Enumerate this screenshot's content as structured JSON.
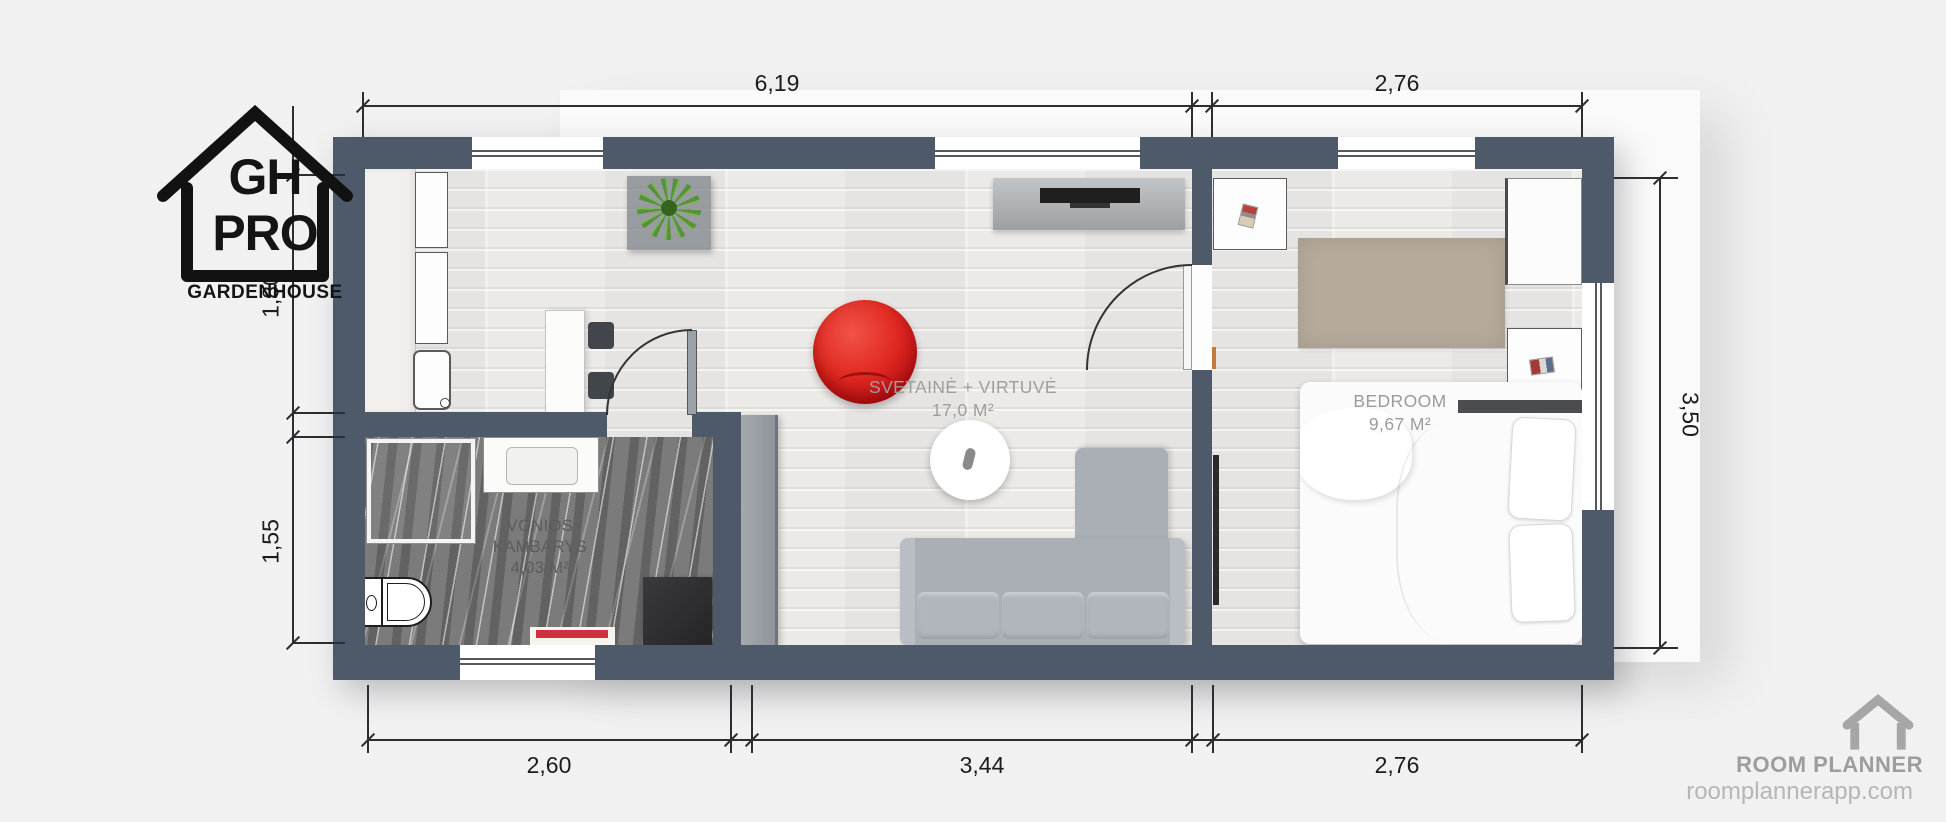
{
  "branding": {
    "logo": {
      "abbr_top": "GH",
      "abbr_bottom": "PRO",
      "caption": "GARDENHOUSE"
    },
    "watermark": {
      "brand": "ROOM PLANNER",
      "website": "roomplannerapp.com"
    }
  },
  "rooms": {
    "living_kitchen": {
      "label": "SVETAINĖ + VIRTUVĖ",
      "area": "17,0 M²"
    },
    "bathroom": {
      "label_line1": "VONIOS",
      "label_line2": "KAMBARYS",
      "area": "4,03 M²"
    },
    "bedroom": {
      "label": "BEDROOM",
      "area": "9,67 M²"
    }
  },
  "dimensions": {
    "top": {
      "living_width": "6,19",
      "bedroom_width": "2,76"
    },
    "bottom": {
      "bathroom_width": "2,60",
      "living_width": "3,44",
      "bedroom_width": "2,76"
    },
    "left": {
      "kitchen_depth": "1,80",
      "bathroom_depth": "1,55"
    },
    "right": {
      "house_depth": "3,50"
    }
  },
  "colors": {
    "wall": "#4e5a69",
    "bean_bag_red": "#d92020",
    "bath_mat_stripe": "#cf2f3f",
    "plant_green": "#5a9e3d",
    "watermark_gray": "#a6a6a6"
  }
}
